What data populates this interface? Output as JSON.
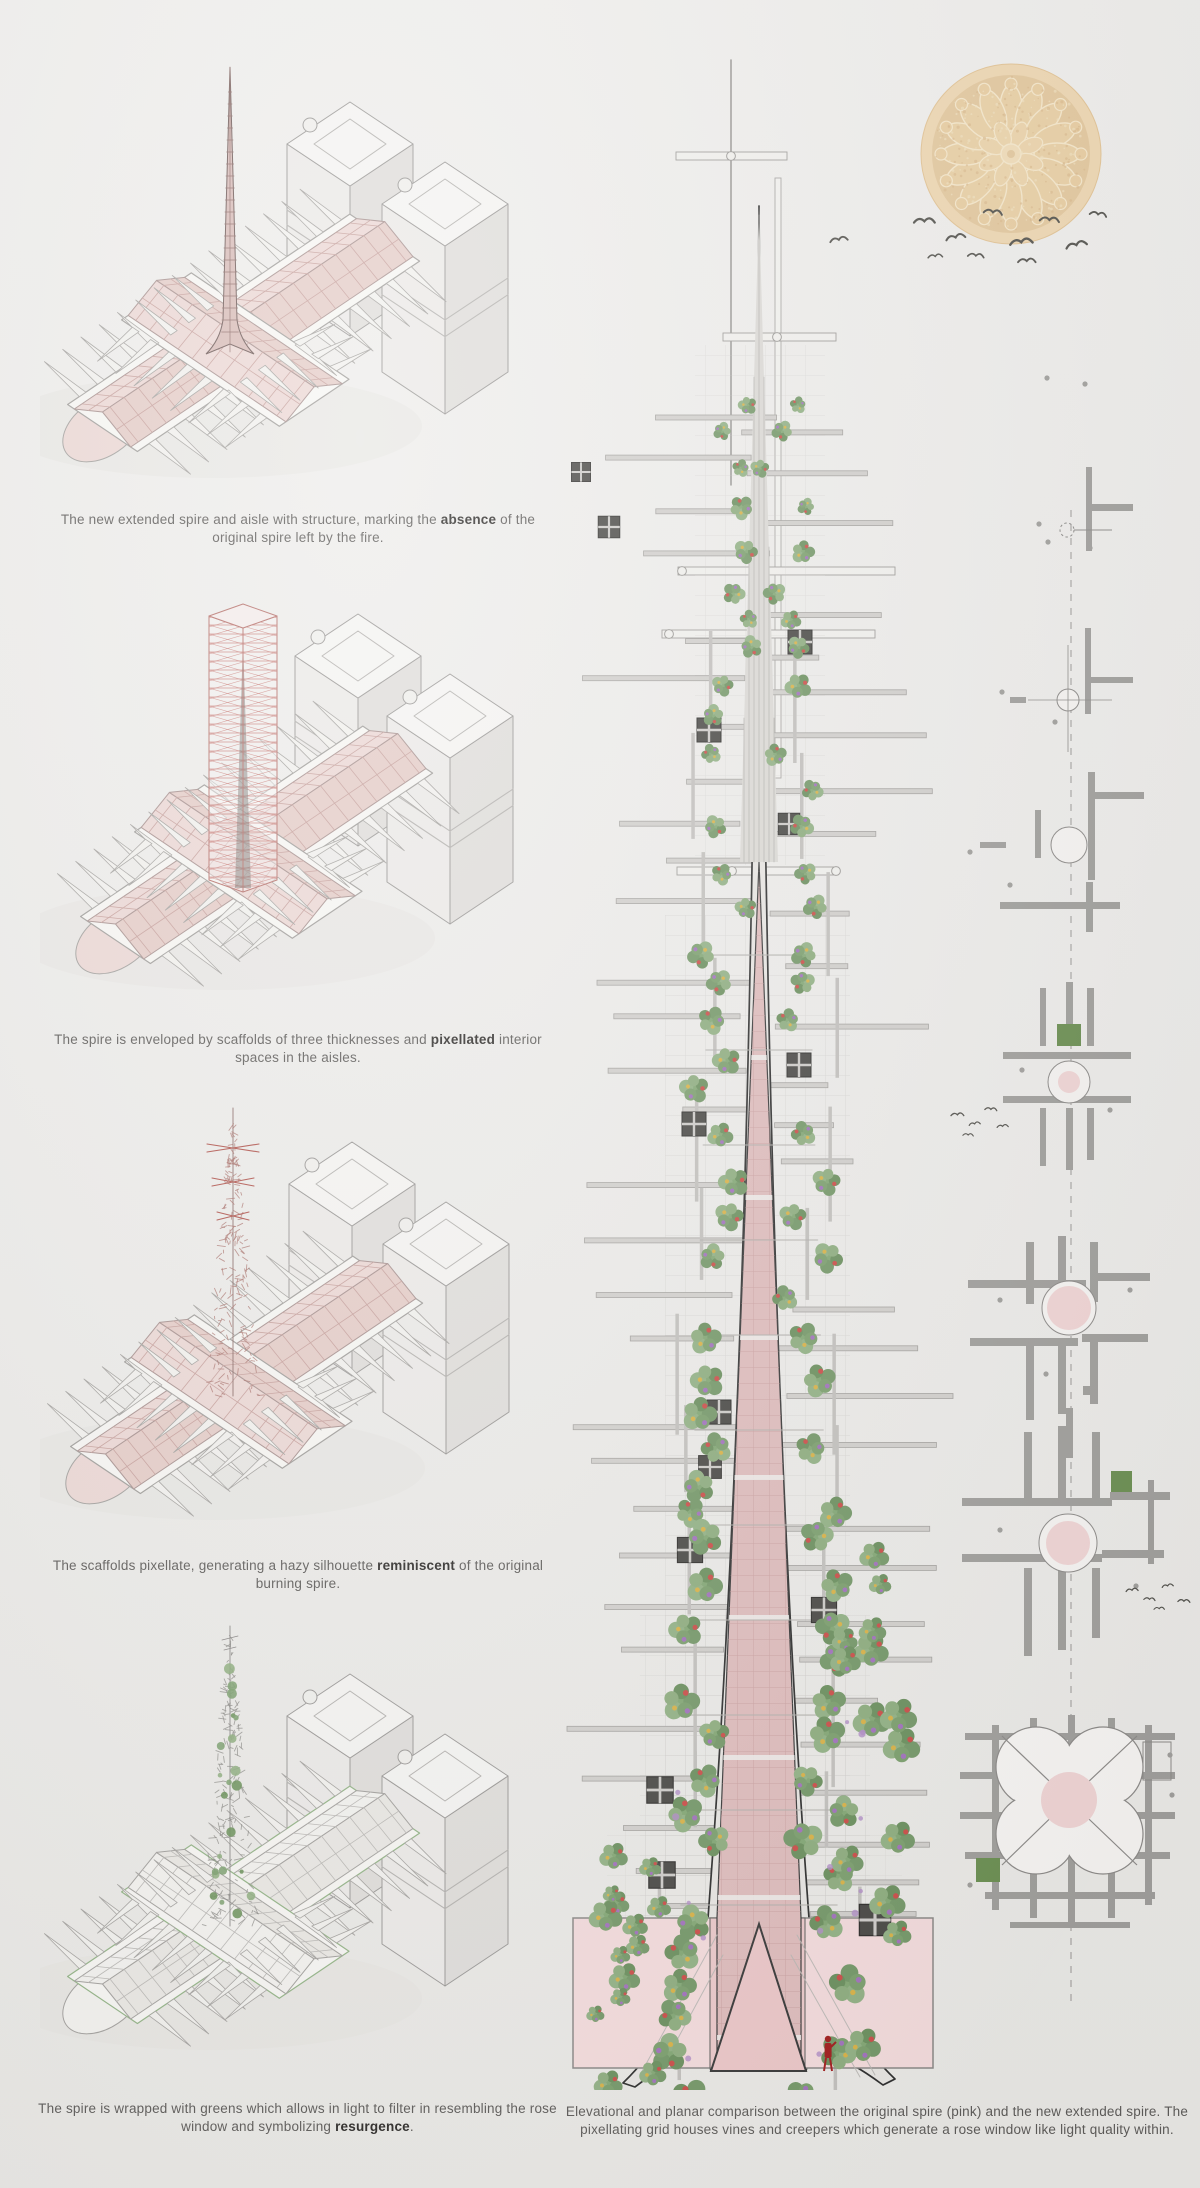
{
  "board": {
    "title": "Notre-Dame spire reconstruction concept board",
    "figures": [
      {
        "caption": {
          "pre": "The new extended spire and aisle with structure, marking the ",
          "bold": "absence",
          "post": " of the original spire left by the fire."
        }
      },
      {
        "caption": {
          "pre": "The spire is enveloped by scaffolds of three thicknesses and ",
          "bold": "pixellated",
          "post": " interior spaces in the aisles."
        }
      },
      {
        "caption": {
          "pre": "The scaffolds pixellate, generating a hazy silhouette ",
          "bold": "reminiscent",
          "post": " of the original burning spire."
        }
      },
      {
        "caption": {
          "pre": "The spire is wrapped with greens which allows in light to filter in resembling the rose window and symbolizing ",
          "bold": "resurgence",
          "post": "."
        }
      }
    ],
    "elevation_caption": "Elevational and planar comparison between the original spire (pink) and the new extended spire. The pixellating grid houses vines and creepers which generate a rose window like light quality within.",
    "colors": {
      "background": "#edecea",
      "original_spire_pink": "#dfbdbd",
      "new_spire_outline": "#2f2f2f",
      "vegetation_green": "#7fa471",
      "scaffold_gray": "#b9b7b4",
      "rose_window_tan": "#eed7b2",
      "figure_red": "#a32020",
      "plan_green_square": "#6d9054",
      "plan_pink_circle": "#f0d5d5"
    }
  }
}
